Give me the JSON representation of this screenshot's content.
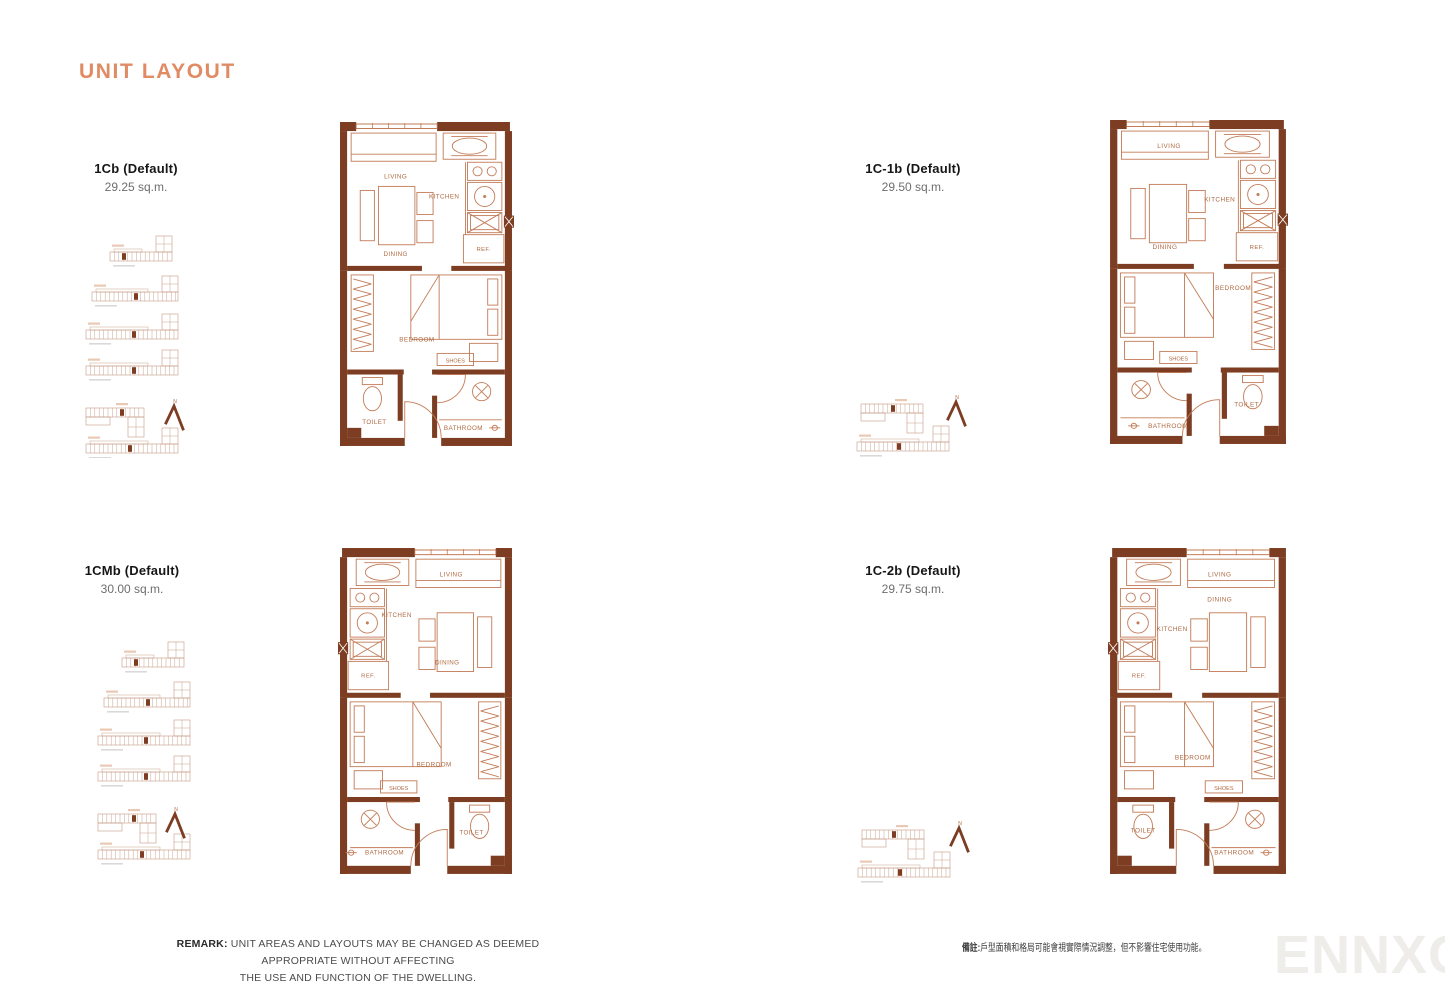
{
  "page": {
    "title": "UNIT LAYOUT",
    "watermark": "ENNXO"
  },
  "colors": {
    "accent": "#E18B64",
    "wall": "#7C3D22",
    "furniture": "#C27C58",
    "plan_text": "#AF6A42",
    "keyline": "#C59A82"
  },
  "north_label": "N",
  "units": [
    {
      "name": "1Cb (Default)",
      "area": "29.25 sq.m.",
      "rooms": {
        "living": "LIVING",
        "kitchen": "KITCHEN",
        "dining": "DINING",
        "ref": "REF.",
        "bedroom": "BEDROOM",
        "shoes": "SHOES",
        "toilet": "TOILET",
        "bathroom": "BATHROOM"
      }
    },
    {
      "name": "1C-1b (Default)",
      "area": "29.50 sq.m.",
      "rooms": {
        "living": "LIVING",
        "kitchen": "KITCHEN",
        "dining": "DINING",
        "ref": "REF.",
        "bedroom": "BEDROOM",
        "shoes": "SHOES",
        "toilet": "TOILET",
        "bathroom": "BATHROOM"
      }
    },
    {
      "name": "1CMb (Default)",
      "area": "30.00 sq.m.",
      "rooms": {
        "living": "LIVING",
        "kitchen": "KITCHEN",
        "dining": "DINING",
        "ref": "REF.",
        "bedroom": "BEDROOM",
        "shoes": "SHOES",
        "toilet": "TOILET",
        "bathroom": "BATHROOM"
      }
    },
    {
      "name": "1C-2b (Default)",
      "area": "29.75 sq.m.",
      "rooms": {
        "living": "LIVING",
        "kitchen": "KITCHEN",
        "dining": "DINING",
        "ref": "REF.",
        "bedroom": "BEDROOM",
        "shoes": "SHOES",
        "toilet": "TOILET",
        "bathroom": "BATHROOM"
      }
    }
  ],
  "remark": {
    "label": "REMARK:",
    "line1": "UNIT AREAS AND LAYOUTS MAY BE CHANGED AS DEEMED APPROPRIATE WITHOUT AFFECTING",
    "line2": "THE USE AND FUNCTION OF THE DWELLING."
  },
  "remark_zh": {
    "label": "備註:",
    "text": "戶型面積和格局可能會視實際情況調整，但不影響住宅使用功能。"
  }
}
